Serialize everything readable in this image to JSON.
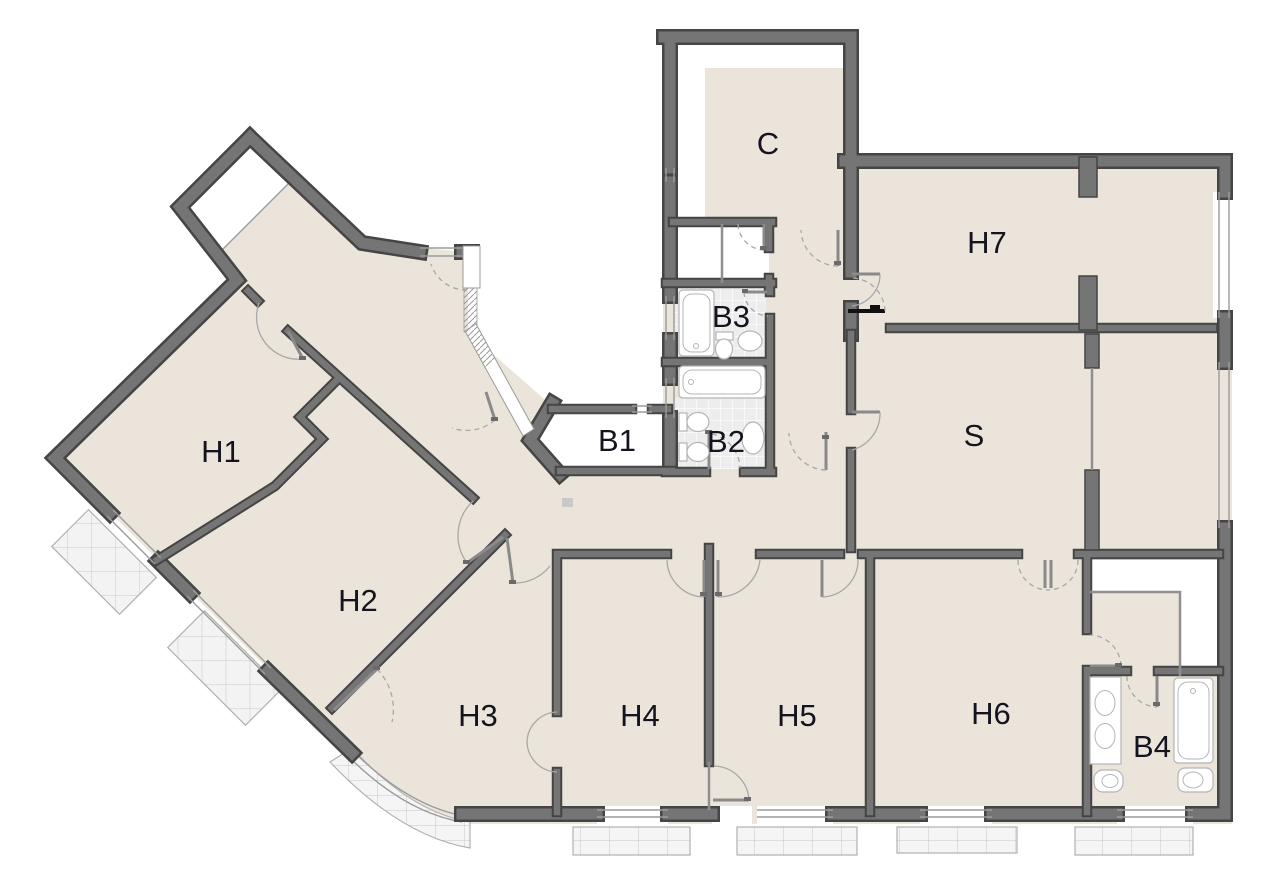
{
  "plan": {
    "rooms": {
      "h1": {
        "label": "H1"
      },
      "h2": {
        "label": "H2"
      },
      "h3": {
        "label": "H3"
      },
      "h4": {
        "label": "H4"
      },
      "h5": {
        "label": "H5"
      },
      "h6": {
        "label": "H6"
      },
      "h7": {
        "label": "H7"
      },
      "s": {
        "label": "S"
      },
      "c": {
        "label": "C"
      },
      "b1": {
        "label": "B1"
      },
      "b2": {
        "label": "B2"
      },
      "b3": {
        "label": "B3"
      },
      "b4": {
        "label": "B4"
      }
    },
    "colors": {
      "floor": "#EBE4DA",
      "wall": "#757575",
      "walledge": "#454545",
      "tile": "#EDEDED",
      "balcony": "#F5F5F5",
      "line": "#9B9B9B",
      "label": "#14141E"
    }
  }
}
